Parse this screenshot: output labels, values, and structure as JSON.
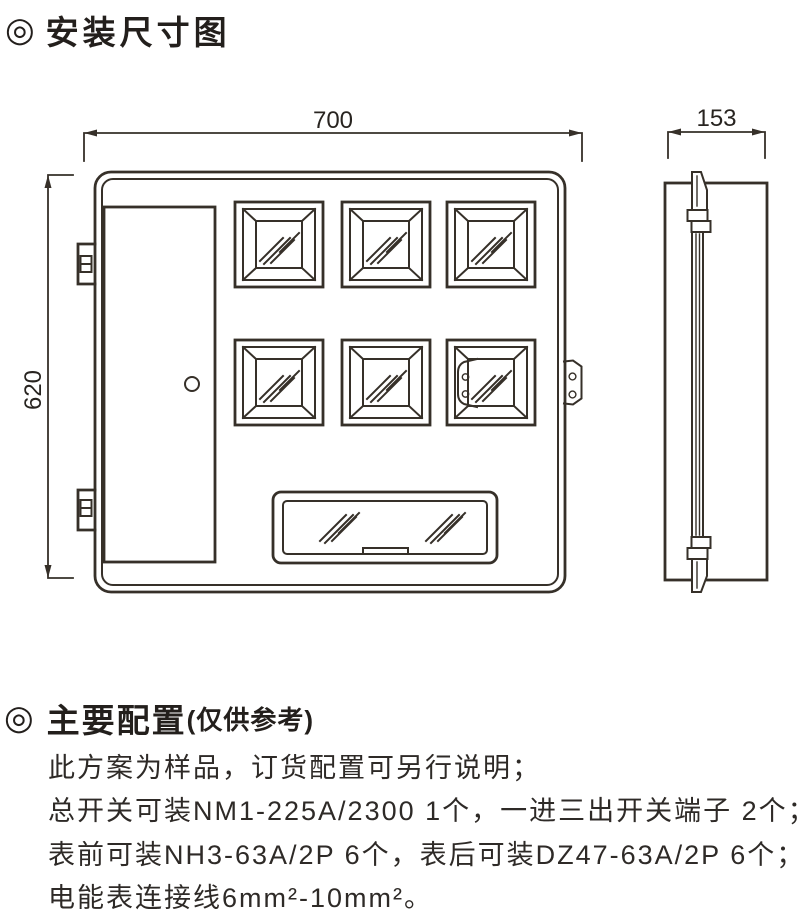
{
  "sections": {
    "install": {
      "bullet": "◎",
      "title": "安装尺寸图"
    },
    "config": {
      "bullet": "◎",
      "title": "主要配置",
      "subtitle": "(仅供参考)",
      "lines": [
        "此方案为样品，订货配置可另行说明；",
        "总开关可装NM1-225A/2300 1个，一进三出开关端子 2个；",
        "表前可装NH3-63A/2P 6个，表后可装DZ47-63A/2P 6个；",
        "电能表连接线6mm²-10mm²。"
      ]
    }
  },
  "drawing": {
    "front_view": {
      "width_label": "700",
      "height_label": "620"
    },
    "side_view": {
      "depth_label": "153"
    },
    "colors": {
      "line": "#363029",
      "text": "#282420"
    }
  }
}
